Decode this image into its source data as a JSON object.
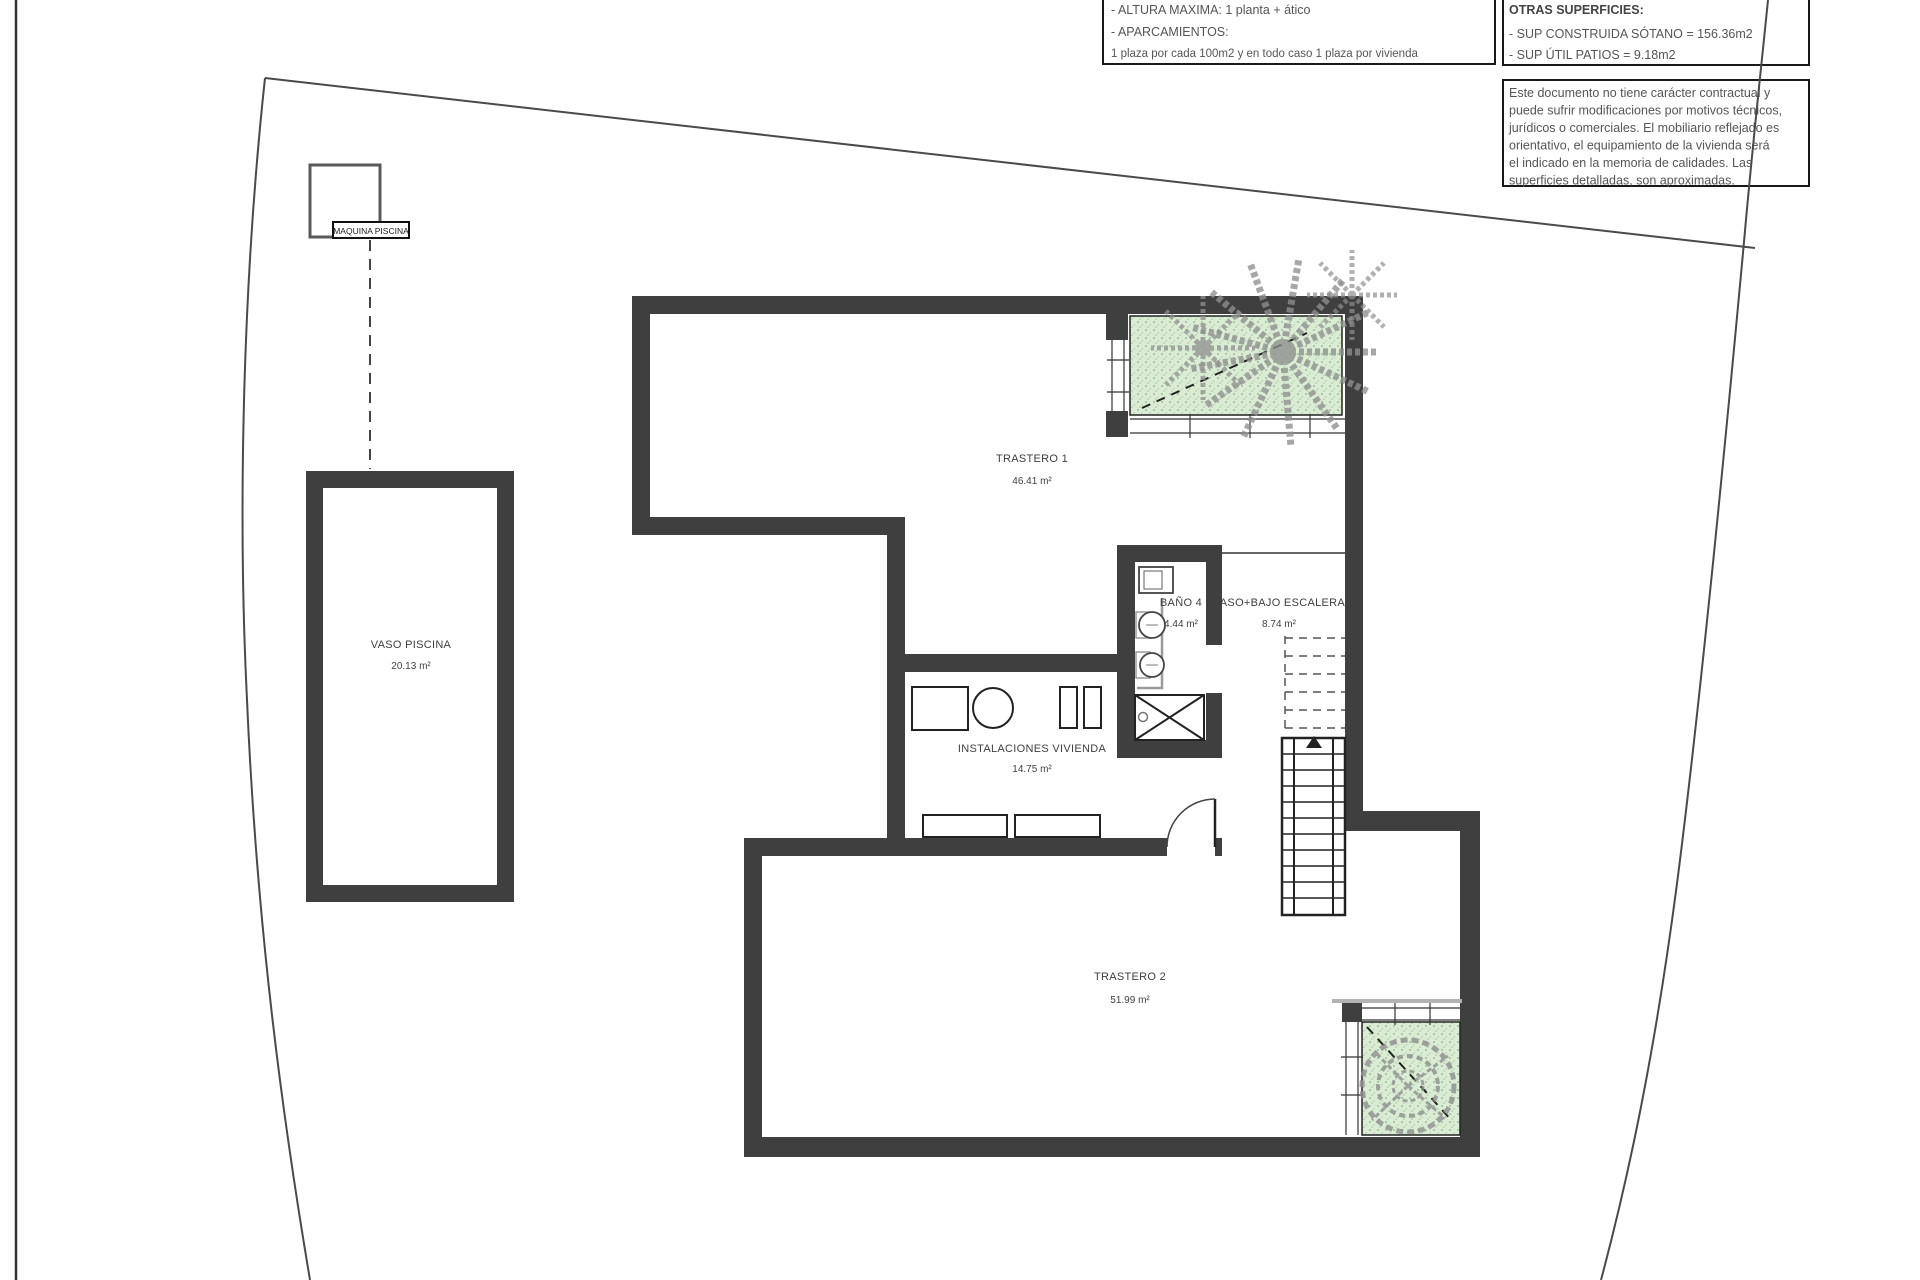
{
  "drawing": {
    "planning_box": {
      "lines": [
        "- ALTURA MAXIMA: 1 planta + ático",
        "- APARCAMIENTOS:",
        "1 plaza por cada 100m2 y en todo caso 1 plaza por vivienda"
      ]
    },
    "surfaces_box": {
      "title": "OTRAS SUPERFICIES:",
      "lines": [
        "- SUP CONSTRUIDA SÓTANO =  156.36m2",
        "- SUP ÚTIL PATIOS =  9.18m2"
      ]
    },
    "disclaimer_box": {
      "lines": [
        "Este documento no tiene carácter contractual y",
        "puede sufrir modificaciones por motivos técnicos,",
        "jurídicos o comerciales. El mobiliario reflejado es",
        "orientativo, el equipamiento de la vivienda será",
        "el indicado en la memoria de calidades. Las",
        "superficies detalladas, son aproximadas."
      ]
    },
    "rooms": {
      "trastero1": {
        "name": "TRASTERO 1",
        "area": "46.41 m²"
      },
      "bano4": {
        "name": "BAÑO 4",
        "area": "4.44 m²"
      },
      "paso": {
        "name": "PASO+BAJO ESCALERA",
        "area": "8.74 m²"
      },
      "instalaciones": {
        "name": "INSTALACIONES VIVIENDA",
        "area": "14.75 m²"
      },
      "trastero2": {
        "name": "TRASTERO 2",
        "area": "51.99 m²"
      },
      "vaso_piscina": {
        "name": "VASO PISCINA",
        "area": "20.13 m²"
      },
      "maquina_piscina": {
        "name": "MAQUINA PISCINA"
      }
    },
    "colors": {
      "wall": "#3f3f3f",
      "patio_green": "#daecd3",
      "plant_gray": "#8f8f8f",
      "boundary_line": "#4a4a4a",
      "box_border": "#1a1a1a"
    }
  }
}
